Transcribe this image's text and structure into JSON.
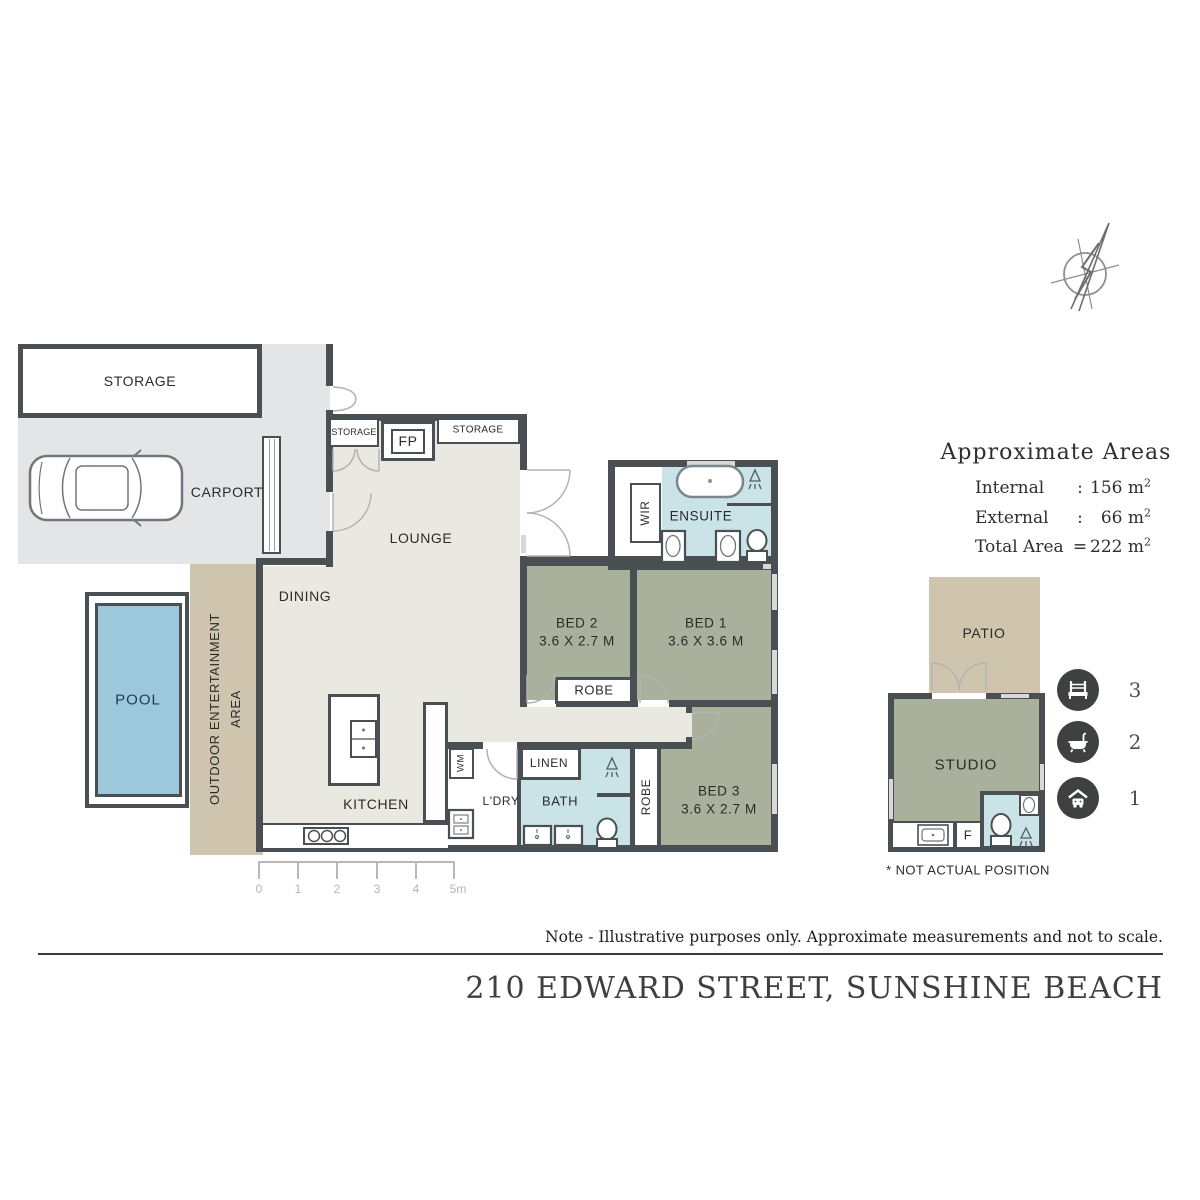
{
  "address": "210 EDWARD STREET, SUNSHINE BEACH",
  "note": "Note - Illustrative purposes only. Approximate measurements and not to scale.",
  "footnote": "* NOT ACTUAL POSITION",
  "areas": {
    "title": "Approximate Areas",
    "rows": [
      {
        "label": "Internal",
        "sep": ":",
        "value": "156 m",
        "sup": "2"
      },
      {
        "label": "External",
        "sep": ":",
        "value": "66 m",
        "sup": "2"
      },
      {
        "label": "Total Area",
        "sep": "=",
        "value": "222 m",
        "sup": "2"
      }
    ]
  },
  "summary": {
    "beds": "3",
    "baths": "2",
    "cars": "1"
  },
  "rooms": {
    "storage_building": "STORAGE",
    "carport": "CARPORT",
    "storage_left": "STORAGE",
    "fireplace": "FP",
    "storage_right": "STORAGE",
    "lounge": "LOUNGE",
    "dining": "DINING",
    "kitchen": "KITCHEN",
    "pool": "POOL",
    "outdoor_line1": "OUTDOOR ENTERTAINMENT",
    "outdoor_line2": "AREA",
    "wir": "WIR",
    "ensuite": "ENSUITE",
    "bed1_name": "BED 1",
    "bed1_dims": "3.6 X 3.6 M",
    "bed2_name": "BED 2",
    "bed2_dims": "3.6 X 2.7 M",
    "bed3_name": "BED 3",
    "bed3_dims": "3.6 X 2.7 M",
    "robe": "ROBE",
    "robe_hall": "ROBE",
    "linen": "LINEN",
    "bath": "BATH",
    "laundry": "L'DRY",
    "washing_machine": "WM",
    "patio": "PATIO",
    "studio": "STUDIO",
    "fridge": "F"
  },
  "scalebar": {
    "ticks": [
      "0",
      "1",
      "2",
      "3",
      "4",
      "5m"
    ]
  },
  "colors": {
    "wall": "#4a4f54",
    "floor": "#e9e9e1",
    "bedroom": "#a9b09b",
    "wet_area": "#c9e3e7",
    "pool": "#9dc7db",
    "outdoor": "#cfc5ae",
    "carport": "#e4e5e7",
    "icon_circle": "#3f4042"
  }
}
